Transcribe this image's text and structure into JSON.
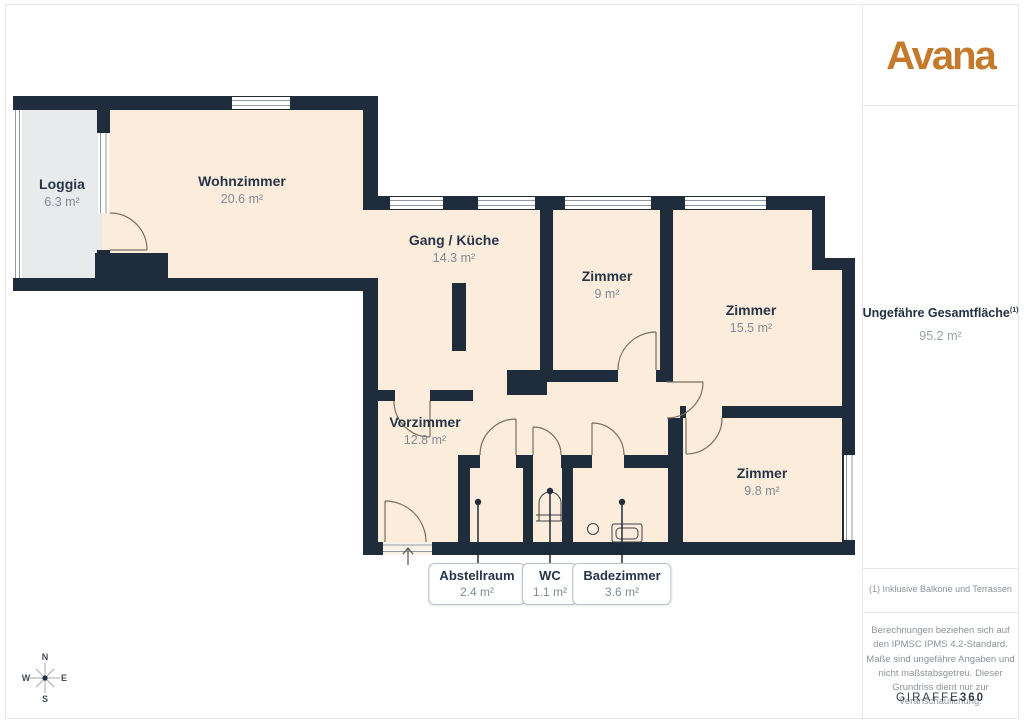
{
  "brand": {
    "logo": "Avana"
  },
  "plan": {
    "rooms": [
      {
        "label": "Loggia",
        "area": "6.3 m²"
      },
      {
        "label": "Wohnzimmer",
        "area": "20.6 m²"
      },
      {
        "label": "Gang / Küche",
        "area": "14.3 m²"
      },
      {
        "label": "Zimmer",
        "area": "9 m²"
      },
      {
        "label": "Zimmer",
        "area": "15.5 m²"
      },
      {
        "label": "Vorzimmer",
        "area": "12.8 m²"
      },
      {
        "label": "Zimmer",
        "area": "9.8 m²"
      }
    ],
    "callouts": [
      {
        "label": "Abstellraum",
        "area": "2.4 m²"
      },
      {
        "label": "WC",
        "area": "1.1 m²"
      },
      {
        "label": "Badezimmer",
        "area": "3.6 m²"
      }
    ],
    "compass": {
      "n": "N",
      "e": "E",
      "s": "S",
      "w": "W"
    }
  },
  "sidebar": {
    "total_label": "Ungefähre Gesamtfläche",
    "total_sup": "(1)",
    "total_value": "95.2 m²",
    "footnote": "(1) Inklusive Balkone und Terrassen",
    "disclaimer": "Berechnungen beziehen sich auf den IPMSC IPMS 4.2-Standard. Maße sind ungefähre Angaben und nicht maßstabsgetreu. Dieser Grundriss dient nur zur Veranschaulichung.",
    "credit_brand": "GIRAFFE",
    "credit_num": "360"
  },
  "colors": {
    "wall": "#1e2c3b",
    "room": "#fcecdb",
    "loggia": "#e9eaeb",
    "accent": "#c5792a"
  }
}
